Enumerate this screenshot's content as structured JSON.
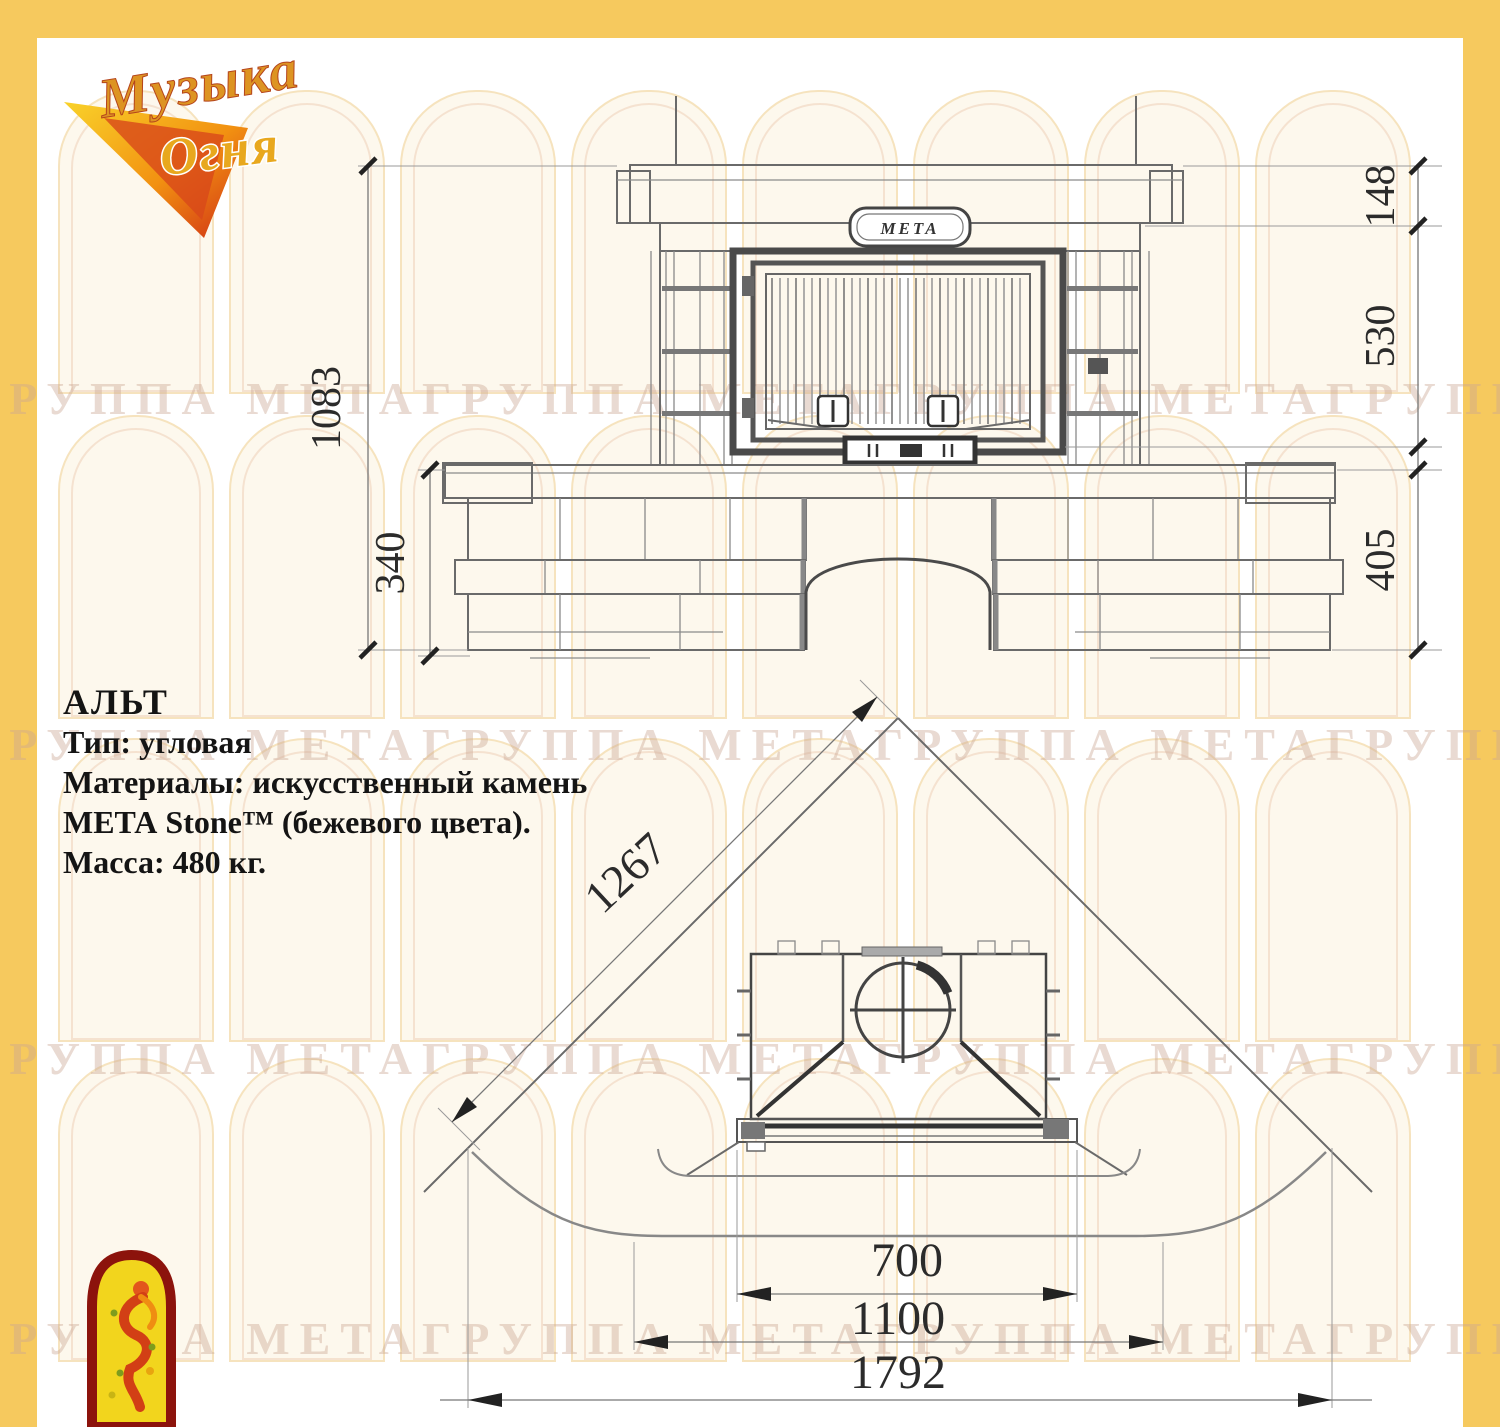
{
  "frame": {
    "border_color": "#f6c95e",
    "paper_color": "#ffffff"
  },
  "logo": {
    "word1": "Музыка",
    "word2": "Огня"
  },
  "specs": {
    "title": "АЛЬТ",
    "line_type": "Тип: угловая",
    "line_material_1": "Материалы: искусственный камень",
    "line_material_2": "МЕТА Stone™ (бежевого цвета).",
    "line_mass": "Масса: 480 кг."
  },
  "front_view": {
    "brand_badge": "МЕТА",
    "dim_total_height": "1083",
    "dim_bench_height": "340",
    "dim_crown_height": "148",
    "dim_firebox_height": "530",
    "dim_base_height": "405"
  },
  "plan_view": {
    "dim_wall_length": "1267",
    "dim_firebox_width": "700",
    "dim_hearth_width": "1100",
    "dim_overall_width": "1792"
  },
  "watermark": {
    "text": "ГРУППА МЕТАГРУППА МЕТАГРУППА МЕТАГРУППА МЕТА"
  }
}
